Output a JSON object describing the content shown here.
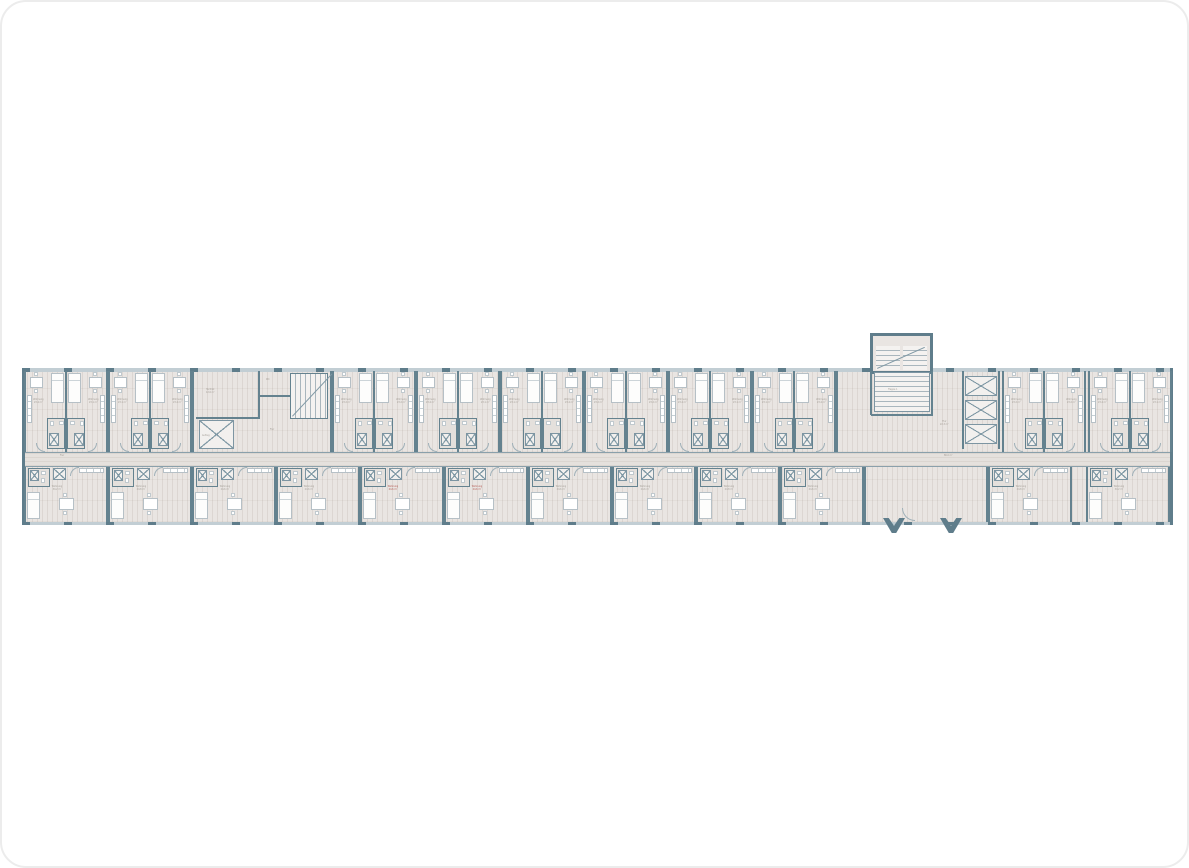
{
  "page": {
    "background": "#ffffff",
    "corner_radius_px": 26,
    "border_color": "#ececec"
  },
  "floor_plan": {
    "kind": "residential-slab-double-loaded-corridor",
    "colors": {
      "wall_dark": "#5f7d8b",
      "wall_medium": "#64828f",
      "wall_light": "#8aa0ab",
      "window": "#c2ced4",
      "floor": "#e9e5e2",
      "corridor_floor": "#e5e1dd",
      "fixture_fill": "#ffffff",
      "fixture_line": "#b6c0c6",
      "label": "#a19b94",
      "flag_label": "#b0524a"
    },
    "labels": {
      "unit": "Wohnung",
      "bath": "Bad",
      "corridor": "Flur",
      "tech": "Technik",
      "wc": "WC",
      "stair_west": "Treppe 2",
      "stair_east": "Treppe 1",
      "lift": "Aufzug",
      "shaft": "Abst.",
      "hall": "Flur"
    },
    "corridor": {
      "label": "Flur",
      "area": "86.0 m²"
    },
    "cores": {
      "west": {
        "tech": "Technik",
        "tech_area": "12.6 m²",
        "wc": "WC",
        "stair": "Treppe 2",
        "lift": "Aufzug"
      },
      "east": {
        "stair": "Treppe 1",
        "hall": "Flur",
        "hall_area": "22.3 m²",
        "shafts": [
          "Abst.",
          "Abst.",
          "Abst."
        ]
      }
    },
    "modules": {
      "top": [
        {
          "x": 2,
          "area_l": "23.4 m²",
          "area_r": "23.1 m²"
        },
        {
          "x": 86,
          "area_l": "23.1 m²",
          "area_r": "23.4 m²"
        },
        {
          "x": 310,
          "area_l": "23.2 m²",
          "area_r": "23.2 m²"
        },
        {
          "x": 394,
          "area_l": "23.4 m²",
          "area_r": "23.1 m²"
        },
        {
          "x": 478,
          "area_l": "23.1 m²",
          "area_r": "23.4 m²"
        },
        {
          "x": 562,
          "area_l": "23.2 m²",
          "area_r": "23.2 m²"
        },
        {
          "x": 646,
          "area_l": "23.4 m²",
          "area_r": "23.1 m²"
        },
        {
          "x": 730,
          "area_l": "23.1 m²",
          "area_r": "23.4 m²"
        },
        {
          "x": 980,
          "area_l": "23.2 m²",
          "area_r": "23.2 m²"
        },
        {
          "x": 1066,
          "area_l": "23.4 m²",
          "area_r": "23.1 m²"
        }
      ],
      "bottom": [
        {
          "x": 2,
          "area": "30.2 m²"
        },
        {
          "x": 86,
          "area": "24.8 m²"
        },
        {
          "x": 170,
          "area": "24.6 m²"
        },
        {
          "x": 254,
          "area": "24.6 m²"
        },
        {
          "x": 338,
          "area": "24.6 m²",
          "flag": true
        },
        {
          "x": 422,
          "area": "24.6 m²",
          "flag": true
        },
        {
          "x": 506,
          "area": "24.6 m²"
        },
        {
          "x": 590,
          "area": "24.6 m²"
        },
        {
          "x": 674,
          "area": "24.8 m²"
        },
        {
          "x": 758,
          "area": "24.6 m²"
        },
        {
          "x": 966,
          "area": "24.8 m²"
        },
        {
          "x": 1064,
          "area": "30.2 m²"
        }
      ]
    },
    "entrance": {
      "canopy_marks": 2
    }
  }
}
